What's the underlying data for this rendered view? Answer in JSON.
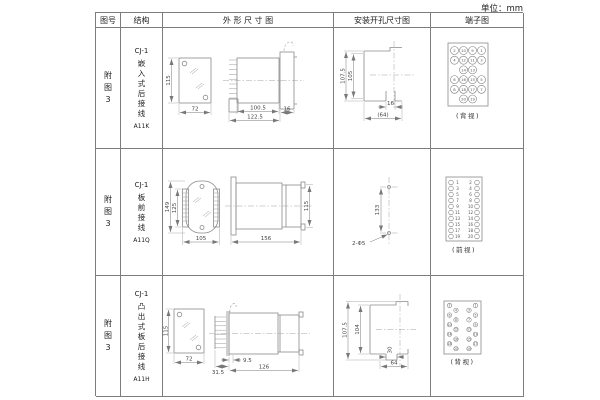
{
  "page": {
    "units_label": "单位：mm"
  },
  "table": {
    "headers": {
      "fig_no": "图号",
      "structure": "结构",
      "outline": "外 形 尺 寸 图",
      "mounting": "安装开孔尺寸图",
      "terminal": "端子图"
    },
    "rows": [
      {
        "fig_no": "附图3",
        "fig_no_lines": [
          "附",
          "图",
          "3"
        ],
        "model": "CJ-1",
        "structure": "嵌入式后接线",
        "structure_lines": [
          "嵌",
          "入",
          "式",
          "后",
          "接",
          "线"
        ],
        "code": "A11K",
        "outline_dims": {
          "front_height": "115",
          "front_width": "72",
          "body_depth": "100.5",
          "total_depth": "122.5",
          "flange": "16"
        },
        "mounting_dims": {
          "outer_height": "107.5",
          "inner_height": "105",
          "width": "16",
          "width_overall": "(64)"
        },
        "terminal": {
          "view_label": "(背视)",
          "grid": [
            [
              "2",
              "10",
              "9",
              "1"
            ],
            [
              "4",
              "12",
              "11",
              "3"
            ],
            [
              "",
              "14",
              "13",
              ""
            ],
            [
              "6",
              "16",
              "15",
              "5"
            ],
            [
              "8",
              "18",
              "17",
              "7"
            ],
            [
              "",
              "20",
              "19",
              ""
            ]
          ]
        }
      },
      {
        "fig_no": "附图3",
        "fig_no_lines": [
          "附",
          "图",
          "3"
        ],
        "model": "CJ-1",
        "structure": "板前接线",
        "structure_lines": [
          "板",
          "前",
          "接",
          "线"
        ],
        "code": "A11Q",
        "outline_dims": {
          "front_height": "149",
          "front_inner_height": "125",
          "front_width": "105",
          "side_length": "156",
          "side_height": "115"
        },
        "mounting_dims": {
          "hole_pitch": "133",
          "holes": "2-Φ5"
        },
        "terminal": {
          "view_label": "(前视)",
          "left_column": [
            "1",
            "3",
            "5",
            "7",
            "9",
            "11",
            "13",
            "15",
            "17",
            "19"
          ],
          "right_column": [
            "2",
            "4",
            "6",
            "8",
            "10",
            "12",
            "14",
            "16",
            "18",
            "20"
          ]
        }
      },
      {
        "fig_no": "附图3",
        "fig_no_lines": [
          "附",
          "图",
          "3"
        ],
        "model": "CJ-1",
        "structure": "凸出式板后接线",
        "structure_lines": [
          "凸",
          "出",
          "式",
          "板",
          "后",
          "接",
          "线"
        ],
        "code": "A11H",
        "outline_dims": {
          "front_height": "115",
          "front_width": "72",
          "pin_length": "31.5",
          "pin_offset": "9.5",
          "side_length": "126"
        },
        "mounting_dims": {
          "outer_height": "107.5",
          "inner_height": "104",
          "slot_width": "30",
          "width_overall": "64"
        },
        "terminal": {
          "view_label": "(背视)",
          "left_column": [
            "2",
            "4",
            "6",
            "8",
            "10",
            "12",
            "14",
            "16",
            "18",
            "20"
          ],
          "right_column": [
            "1",
            "3",
            "5",
            "7",
            "9",
            "11",
            "13",
            "15",
            "17",
            "19"
          ]
        }
      }
    ]
  }
}
